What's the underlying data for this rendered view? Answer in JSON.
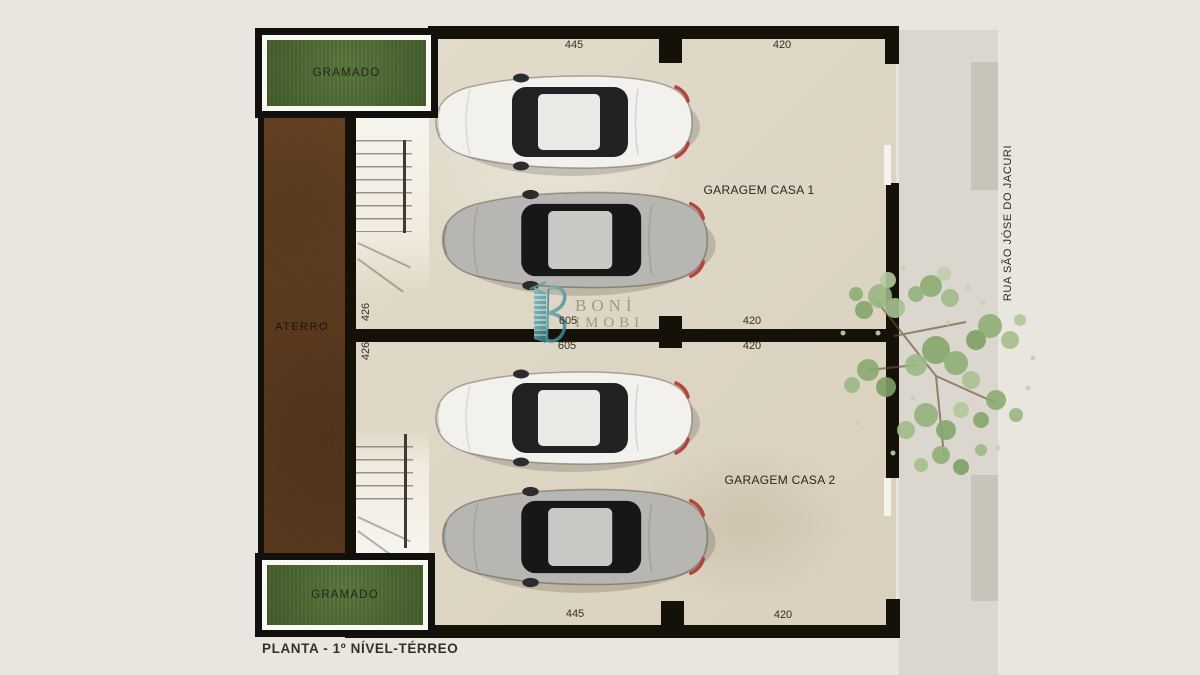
{
  "title": "PLANTA - 1º NÍVEL-TÉRREO",
  "street": {
    "name": "RUA SÃO JÓSE DO JACURI"
  },
  "areas": {
    "lawn_top": "GRAMADO",
    "lawn_bottom": "GRAMADO",
    "earth_fill": "ATERRO",
    "garage_house_1": "GARAGEM CASA 1",
    "garage_house_2": "GARAGEM CASA 2"
  },
  "dims": {
    "top_left": "445",
    "top_right": "420",
    "mid_above_left": "605",
    "mid_above_right": "420",
    "mid_below_left": "605",
    "mid_below_right": "420",
    "side_garage1": "426",
    "side_garage2": "426",
    "bottom_left": "445",
    "bottom_right": "420"
  },
  "watermark": {
    "brand_line1": "BONİ",
    "brand_line2": "IMOBI"
  },
  "colors": {
    "background": "#e9e6df",
    "floor": "#ddd5c4",
    "wall": "#141109",
    "grass": "#52703a",
    "earth": "#6e4726",
    "sidewalk": "#dbd7cf",
    "ramp": "#c8c4b9",
    "foliage": "#8fae76",
    "brand_teal": "#4a969c",
    "car_white": "#f2f1ee",
    "car_silver": "#b7b6b3",
    "taillight_red": "#b5443c"
  }
}
